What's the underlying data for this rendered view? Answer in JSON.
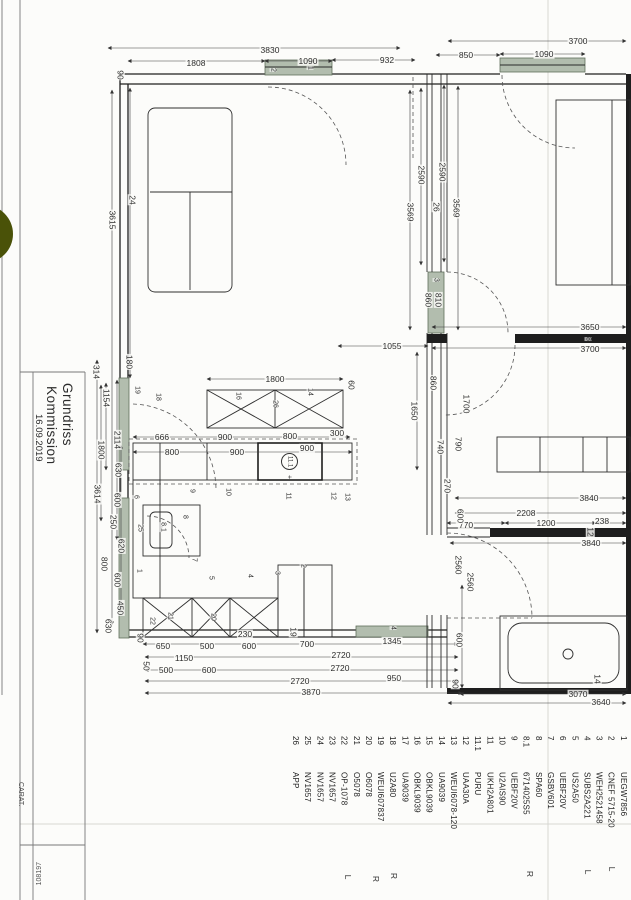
{
  "page": {
    "type_hint": "scanned kitchen floor plan drawing",
    "accent_window_green": "#b2bdae",
    "punch_dot_green": "#4a5208",
    "line_color": "#1f1f1f"
  },
  "title_block": {
    "line1": "Grundriss",
    "line2": "Kommission",
    "date": "16.09.2019",
    "software": "CARAT.",
    "doc_number": "108197"
  },
  "legend": {
    "items": [
      {
        "n": "1",
        "c": "UEGW7856"
      },
      {
        "n": "2",
        "c": "CNEF 5715-20"
      },
      {
        "n": "3",
        "c": "WEH2521458"
      },
      {
        "n": "4",
        "c": "SUBS2A221"
      },
      {
        "n": "5",
        "c": "US2A50"
      },
      {
        "n": "6",
        "c": "UEBF20V"
      },
      {
        "n": "7",
        "c": "GSBV601"
      },
      {
        "n": "8",
        "c": "SPA60"
      },
      {
        "n": "8.1",
        "c": "6714025S5"
      },
      {
        "n": "9",
        "c": "UEBF20V"
      },
      {
        "n": "10",
        "c": "U2AIS90"
      },
      {
        "n": "11",
        "c": "UKH2A801"
      },
      {
        "n": "11.1",
        "c": "PURU"
      },
      {
        "n": "12",
        "c": "UAA30A"
      },
      {
        "n": "13",
        "c": "WEUI6078-120"
      },
      {
        "n": "14",
        "c": "UA9039"
      },
      {
        "n": "15",
        "c": "OBKL9039"
      },
      {
        "n": "16",
        "c": "OBKL9039"
      },
      {
        "n": "17",
        "c": "UA9039"
      },
      {
        "n": "18",
        "c": "U2A80"
      },
      {
        "n": "19",
        "c": "WEUI607837"
      },
      {
        "n": "20",
        "c": "O6078"
      },
      {
        "n": "21",
        "c": "O5078"
      },
      {
        "n": "22",
        "c": "OP-1078"
      },
      {
        "n": "23",
        "c": "NV1657"
      },
      {
        "n": "24",
        "c": "NV1657"
      },
      {
        "n": "25",
        "c": "NV1657"
      },
      {
        "n": "26",
        "c": "APP"
      }
    ],
    "markers": [
      {
        "t": "L",
        "x": 612,
        "y": 869
      },
      {
        "t": "L",
        "x": 588,
        "y": 872
      },
      {
        "t": "R",
        "x": 530,
        "y": 874
      },
      {
        "t": "R",
        "x": 394,
        "y": 876
      },
      {
        "t": "R",
        "x": 376,
        "y": 879
      },
      {
        "t": "L",
        "x": 348,
        "y": 877
      }
    ]
  },
  "plan": {
    "circled": {
      "t": "11.1"
    },
    "dims": [
      {
        "t": "3830",
        "x": 270,
        "y": 50,
        "o": "h"
      },
      {
        "t": "1808",
        "x": 196,
        "y": 63,
        "o": "h"
      },
      {
        "t": "1090",
        "x": 308,
        "y": 61,
        "o": "h"
      },
      {
        "t": "932",
        "x": 387,
        "y": 60,
        "o": "h"
      },
      {
        "t": "90",
        "x": 120,
        "y": 75,
        "o": "v"
      },
      {
        "t": "3700",
        "x": 578,
        "y": 41,
        "o": "h"
      },
      {
        "t": "850",
        "x": 466,
        "y": 55,
        "o": "h"
      },
      {
        "t": "1090",
        "x": 544,
        "y": 54,
        "o": "h"
      },
      {
        "t": "3615",
        "x": 112,
        "y": 220,
        "o": "v"
      },
      {
        "t": "24",
        "x": 132,
        "y": 200,
        "o": "v"
      },
      {
        "t": "2590",
        "x": 421,
        "y": 175,
        "o": "v"
      },
      {
        "t": "2590",
        "x": 442,
        "y": 172,
        "o": "v"
      },
      {
        "t": "26",
        "x": 436,
        "y": 207,
        "o": "v"
      },
      {
        "t": "3569",
        "x": 410,
        "y": 212,
        "o": "v"
      },
      {
        "t": "3569",
        "x": 456,
        "y": 208,
        "o": "v"
      },
      {
        "t": "314",
        "x": 96,
        "y": 372,
        "o": "v"
      },
      {
        "t": "180",
        "x": 129,
        "y": 362,
        "o": "v"
      },
      {
        "t": "1154",
        "x": 106,
        "y": 398,
        "o": "v"
      },
      {
        "t": "1800",
        "x": 101,
        "y": 450,
        "o": "v"
      },
      {
        "t": "2114",
        "x": 117,
        "y": 440,
        "o": "v"
      },
      {
        "t": "630",
        "x": 118,
        "y": 470,
        "o": "v"
      },
      {
        "t": "3614",
        "x": 97,
        "y": 494,
        "o": "v"
      },
      {
        "t": "600",
        "x": 117,
        "y": 500,
        "o": "v"
      },
      {
        "t": "250",
        "x": 113,
        "y": 522,
        "o": "v"
      },
      {
        "t": "620",
        "x": 121,
        "y": 546,
        "o": "v"
      },
      {
        "t": "800",
        "x": 104,
        "y": 564,
        "o": "v"
      },
      {
        "t": "600",
        "x": 117,
        "y": 580,
        "o": "v"
      },
      {
        "t": "450",
        "x": 120,
        "y": 608,
        "o": "v"
      },
      {
        "t": "630",
        "x": 108,
        "y": 626,
        "o": "v"
      },
      {
        "t": "860",
        "x": 428,
        "y": 300,
        "o": "v"
      },
      {
        "t": "810",
        "x": 438,
        "y": 300,
        "o": "v"
      },
      {
        "t": "1800",
        "x": 275,
        "y": 379,
        "o": "h"
      },
      {
        "t": "60",
        "x": 351,
        "y": 385,
        "o": "v"
      },
      {
        "t": "666",
        "x": 162,
        "y": 437,
        "o": "h"
      },
      {
        "t": "900",
        "x": 225,
        "y": 437,
        "o": "h"
      },
      {
        "t": "800",
        "x": 290,
        "y": 436,
        "o": "h"
      },
      {
        "t": "300",
        "x": 337,
        "y": 433,
        "o": "h"
      },
      {
        "t": "800",
        "x": 172,
        "y": 452,
        "o": "h"
      },
      {
        "t": "900",
        "x": 237,
        "y": 452,
        "o": "h"
      },
      {
        "t": "900",
        "x": 307,
        "y": 448,
        "o": "h"
      },
      {
        "t": "1055",
        "x": 392,
        "y": 346,
        "o": "h"
      },
      {
        "t": "1650",
        "x": 414,
        "y": 411,
        "o": "v"
      },
      {
        "t": "860",
        "x": 433,
        "y": 383,
        "o": "v"
      },
      {
        "t": "1700",
        "x": 466,
        "y": 404,
        "o": "v"
      },
      {
        "t": "740",
        "x": 440,
        "y": 447,
        "o": "v"
      },
      {
        "t": "790",
        "x": 458,
        "y": 444,
        "o": "v"
      },
      {
        "t": "3650",
        "x": 590,
        "y": 327,
        "o": "h"
      },
      {
        "t": "3700",
        "x": 590,
        "y": 349,
        "o": "h"
      },
      {
        "t": "3840",
        "x": 589,
        "y": 498,
        "o": "h"
      },
      {
        "t": "2208",
        "x": 526,
        "y": 513,
        "o": "h"
      },
      {
        "t": "1200",
        "x": 546,
        "y": 523,
        "o": "h"
      },
      {
        "t": "238",
        "x": 602,
        "y": 521,
        "o": "h"
      },
      {
        "t": "3840",
        "x": 591,
        "y": 543,
        "o": "h"
      },
      {
        "t": "12",
        "x": 590,
        "y": 532,
        "o": "v"
      },
      {
        "t": "770",
        "x": 466,
        "y": 525,
        "o": "h"
      },
      {
        "t": "270",
        "x": 447,
        "y": 486,
        "o": "v"
      },
      {
        "t": "600",
        "x": 460,
        "y": 516,
        "o": "v"
      },
      {
        "t": "2560",
        "x": 458,
        "y": 565,
        "o": "v"
      },
      {
        "t": "2560",
        "x": 470,
        "y": 582,
        "o": "v"
      },
      {
        "t": "600",
        "x": 459,
        "y": 640,
        "o": "v"
      },
      {
        "t": "90",
        "x": 455,
        "y": 684,
        "o": "v"
      },
      {
        "t": "14",
        "x": 597,
        "y": 679,
        "o": "v"
      },
      {
        "t": "3070",
        "x": 578,
        "y": 694,
        "o": "h"
      },
      {
        "t": "3640",
        "x": 601,
        "y": 702,
        "o": "h"
      },
      {
        "t": "90",
        "x": 140,
        "y": 638,
        "o": "v"
      },
      {
        "t": "230",
        "x": 245,
        "y": 634,
        "o": "h"
      },
      {
        "t": "19",
        "x": 293,
        "y": 632,
        "o": "v"
      },
      {
        "t": "650",
        "x": 163,
        "y": 646,
        "o": "h"
      },
      {
        "t": "500",
        "x": 207,
        "y": 646,
        "o": "h"
      },
      {
        "t": "600",
        "x": 249,
        "y": 646,
        "o": "h"
      },
      {
        "t": "700",
        "x": 307,
        "y": 644,
        "o": "h"
      },
      {
        "t": "1345",
        "x": 392,
        "y": 641,
        "o": "h"
      },
      {
        "t": "1150",
        "x": 184,
        "y": 658,
        "o": "h"
      },
      {
        "t": "2720",
        "x": 341,
        "y": 655,
        "o": "h"
      },
      {
        "t": "50",
        "x": 146,
        "y": 666,
        "o": "v"
      },
      {
        "t": "500",
        "x": 166,
        "y": 670,
        "o": "h"
      },
      {
        "t": "600",
        "x": 209,
        "y": 670,
        "o": "h"
      },
      {
        "t": "2720",
        "x": 340,
        "y": 668,
        "o": "h"
      },
      {
        "t": "2720",
        "x": 300,
        "y": 681,
        "o": "h"
      },
      {
        "t": "950",
        "x": 394,
        "y": 678,
        "o": "h"
      },
      {
        "t": "3870",
        "x": 311,
        "y": 692,
        "o": "h"
      }
    ],
    "part_labels": [
      {
        "t": "2",
        "x": 273,
        "y": 70
      },
      {
        "t": "1",
        "x": 310,
        "y": 68
      },
      {
        "t": "19",
        "x": 137,
        "y": 390
      },
      {
        "t": "18",
        "x": 158,
        "y": 397
      },
      {
        "t": "16",
        "x": 238,
        "y": 396
      },
      {
        "t": "26",
        "x": 275,
        "y": 404
      },
      {
        "t": "14",
        "x": 310,
        "y": 392
      },
      {
        "t": "9",
        "x": 192,
        "y": 491
      },
      {
        "t": "10",
        "x": 228,
        "y": 492
      },
      {
        "t": "11",
        "x": 288,
        "y": 496
      },
      {
        "t": "12",
        "x": 333,
        "y": 496
      },
      {
        "t": "13",
        "x": 347,
        "y": 497
      },
      {
        "t": "6",
        "x": 136,
        "y": 497
      },
      {
        "t": "25",
        "x": 140,
        "y": 528
      },
      {
        "t": "8",
        "x": 185,
        "y": 517
      },
      {
        "t": "8.1",
        "x": 163,
        "y": 527
      },
      {
        "t": "7",
        "x": 194,
        "y": 560
      },
      {
        "t": "1",
        "x": 139,
        "y": 571
      },
      {
        "t": "5",
        "x": 211,
        "y": 578
      },
      {
        "t": "4",
        "x": 250,
        "y": 576
      },
      {
        "t": "3",
        "x": 277,
        "y": 573
      },
      {
        "t": "2",
        "x": 303,
        "y": 566
      },
      {
        "t": "20",
        "x": 213,
        "y": 617
      },
      {
        "t": "21",
        "x": 170,
        "y": 616
      },
      {
        "t": "22",
        "x": 152,
        "y": 621
      },
      {
        "t": "3",
        "x": 436,
        "y": 280
      },
      {
        "t": "4",
        "x": 393,
        "y": 628
      },
      {
        "t": "8",
        "x": 588,
        "y": 339
      },
      {
        "t": "+",
        "x": 289,
        "y": 477
      }
    ]
  }
}
